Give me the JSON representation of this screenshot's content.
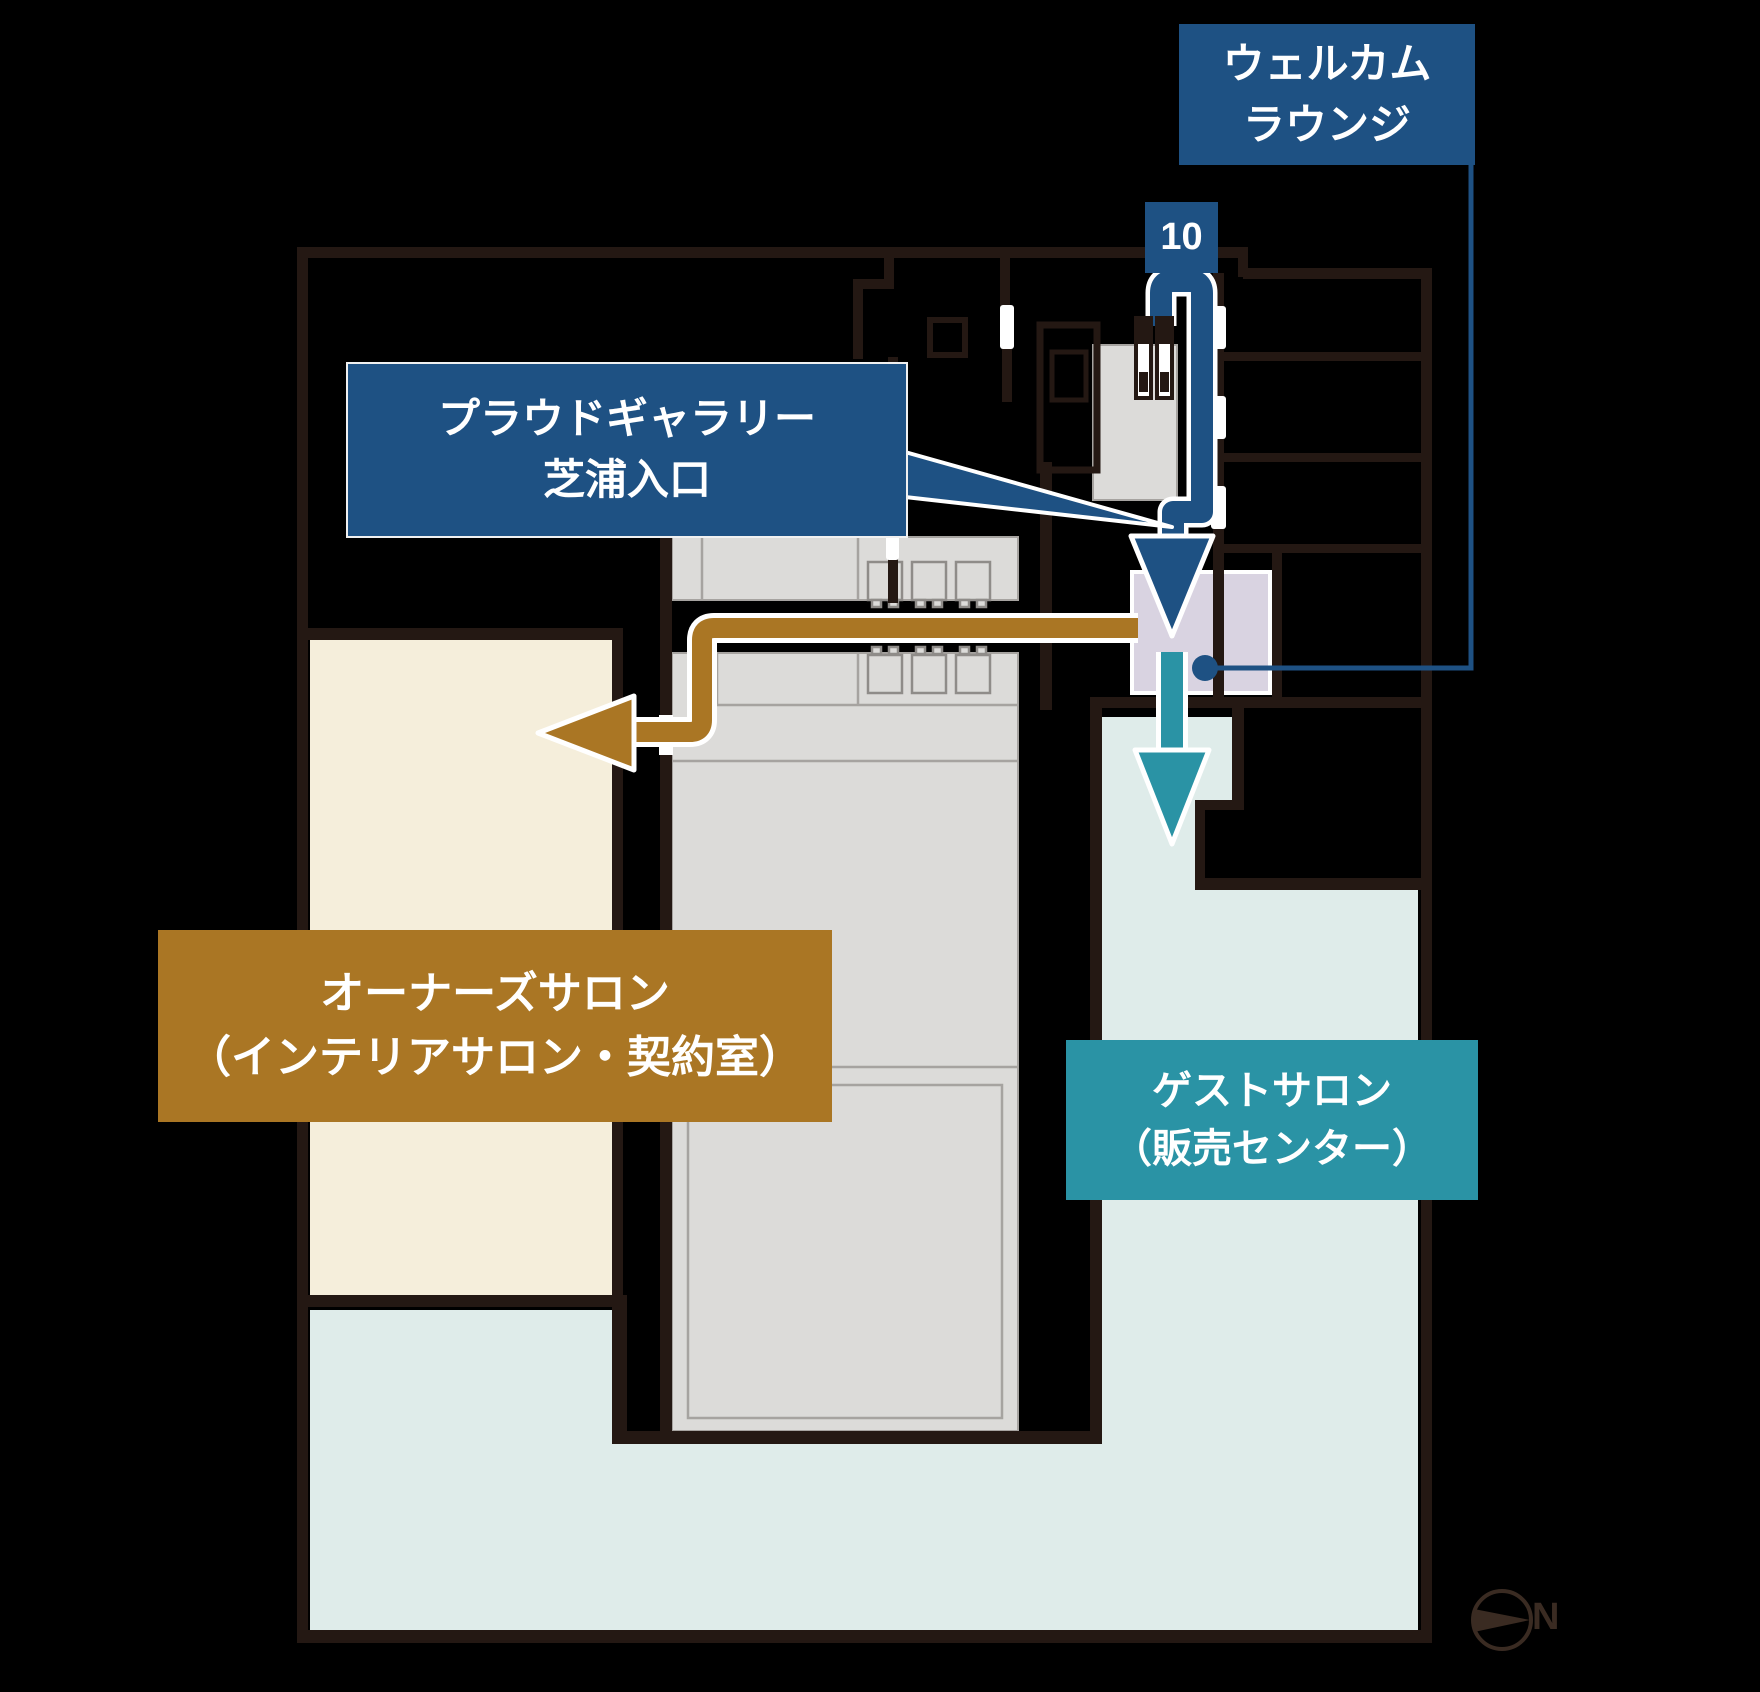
{
  "page": {
    "width": 1760,
    "height": 1692,
    "background": "#000000"
  },
  "colors": {
    "wall": "#241813",
    "accent_blue": "#1e5183",
    "accent_brown": "#aa7624",
    "accent_teal": "#2a93a5",
    "room_cream": "#f5eedb",
    "room_aqua": "#dfecea",
    "room_gray": "#dcdbd9",
    "room_lavender": "#d9d3e1",
    "outline_white": "#ffffff",
    "compass_ink": "#3a2b22"
  },
  "labels": {
    "welcome_lounge": {
      "line1": "ウェルカム",
      "line2": "ラウンジ"
    },
    "entrance_badge": {
      "number": "10"
    },
    "gallery_entrance": {
      "line1": "プラウドギャラリー",
      "line2": "芝浦入口"
    },
    "owners_salon": {
      "line1": "オーナーズサロン",
      "line2": "（インテリアサロン・契約室）"
    },
    "guest_salon": {
      "line1": "ゲストサロン",
      "line2": "（販売センター）"
    },
    "compass": {
      "north": "N"
    }
  }
}
